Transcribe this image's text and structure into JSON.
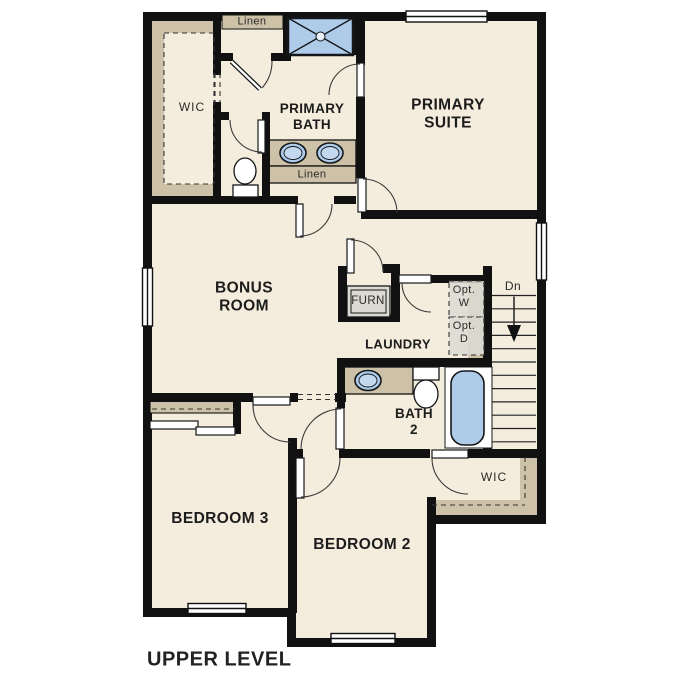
{
  "title": "UPPER LEVEL",
  "labels": {
    "linen_top": "Linen",
    "wic_primary": "WIC",
    "primary_bath": "PRIMARY\nBATH",
    "primary_suite": "PRIMARY\nSUITE",
    "linen_hall": "Linen",
    "bonus_room": "BONUS\nROOM",
    "furnace": "FURN",
    "laundry": "LAUNDRY",
    "opt_washer": "Opt.\nW",
    "opt_dryer": "Opt.\nD",
    "stairs_down": "Dn",
    "bath2": "BATH\n2",
    "bedroom3": "BEDROOM 3",
    "bedroom2": "BEDROOM 2",
    "wic_bedroom2": "WIC",
    "level_title": "UPPER LEVEL"
  },
  "colors": {
    "floor": "#f4eddd",
    "accent_tan": "#cdc1a7",
    "fixture_blue": "#aecbea",
    "wall": "#111111",
    "equipment_gray": "#dcdad2"
  }
}
